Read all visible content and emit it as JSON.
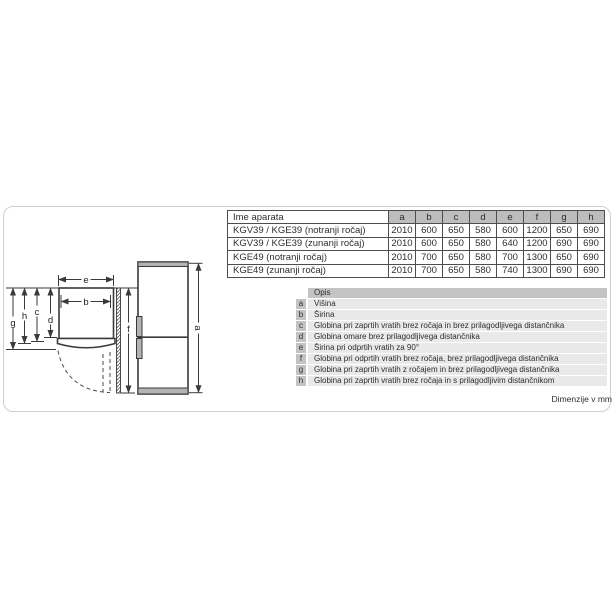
{
  "spec_table": {
    "header_first": "Ime aparata",
    "dim_headers": [
      "a",
      "b",
      "c",
      "d",
      "e",
      "f",
      "g",
      "h"
    ],
    "rows": [
      {
        "name": "KGV39 / KGE39 (notranji ročaj)",
        "values": [
          "2010",
          "600",
          "650",
          "580",
          "600",
          "1200",
          "650",
          "690"
        ]
      },
      {
        "name": "KGV39 / KGE39 (zunanji ročaj)",
        "values": [
          "2010",
          "600",
          "650",
          "580",
          "640",
          "1200",
          "690",
          "690"
        ]
      },
      {
        "name": "KGE49 (notranji ročaj)",
        "values": [
          "2010",
          "700",
          "650",
          "580",
          "700",
          "1300",
          "650",
          "690"
        ]
      },
      {
        "name": "KGE49 (zunanji ročaj)",
        "values": [
          "2010",
          "700",
          "650",
          "580",
          "740",
          "1300",
          "690",
          "690"
        ]
      }
    ]
  },
  "legend": {
    "header": "Opis",
    "items": [
      {
        "key": "a",
        "text": "Višina"
      },
      {
        "key": "b",
        "text": "Širina"
      },
      {
        "key": "c",
        "text": "Globina pri zaprtih vratih brez ročaja in brez prilagodljivega distančnika"
      },
      {
        "key": "d",
        "text": "Globina omare brez prilagodljivega distančnika"
      },
      {
        "key": "e",
        "text": "Širina pri odprtih vratih za 90°"
      },
      {
        "key": "f",
        "text": "Globina pri odprtih vratih brez ročaja, brez prilagodljivega distančnika"
      },
      {
        "key": "g",
        "text": "Globina pri zaprtih vratih z ročajem in brez prilagodljivega distančnika"
      },
      {
        "key": "h",
        "text": "Globina pri zaprtih vratih brez ročaja in s prilagodljivim distančnikom"
      }
    ]
  },
  "footnote": "Dimenzije v mm",
  "diagram": {
    "labels": {
      "a": "a",
      "b": "b",
      "c": "c",
      "d": "d",
      "e": "e",
      "f": "f",
      "g": "g",
      "h": "h"
    }
  },
  "colors": {
    "table_dim_header_bg": "#bdbdbd",
    "legend_header_bg": "#c3c3c3",
    "legend_row_bg": "#e9e9e9",
    "fridge_gray": "#b3b3b3",
    "line": "#3a3a3a",
    "frame": "#cfcfcf"
  }
}
